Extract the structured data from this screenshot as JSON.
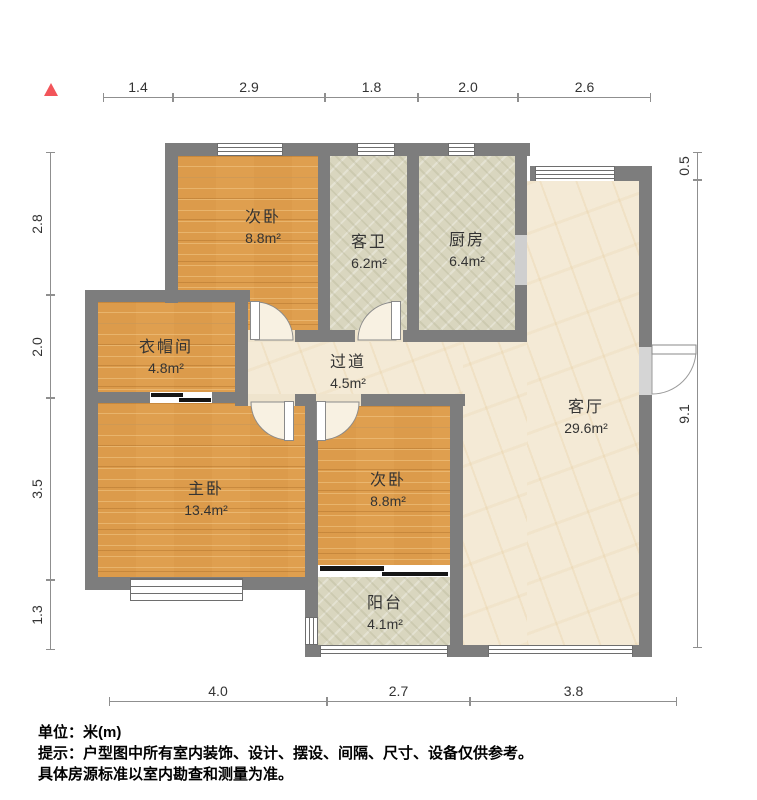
{
  "compass": {
    "icon": "north-triangle",
    "color": "#f2555a"
  },
  "rooms": [
    {
      "key": "bedroom_top",
      "name": "次卧",
      "area": "8.8m²",
      "floor": "wood"
    },
    {
      "key": "guest_bath",
      "name": "客卫",
      "area": "6.2m²",
      "floor": "tile"
    },
    {
      "key": "kitchen",
      "name": "厨房",
      "area": "6.4m²",
      "floor": "tile"
    },
    {
      "key": "hallway",
      "name": "过道",
      "area": "4.5m²",
      "floor": "marble"
    },
    {
      "key": "living_room",
      "name": "客厅",
      "area": "29.6m²",
      "floor": "marble"
    },
    {
      "key": "cloakroom",
      "name": "衣帽间",
      "area": "4.8m²",
      "floor": "wood"
    },
    {
      "key": "master_bedroom",
      "name": "主卧",
      "area": "13.4m²",
      "floor": "wood"
    },
    {
      "key": "bedroom_bottom",
      "name": "次卧",
      "area": "8.8m²",
      "floor": "wood"
    },
    {
      "key": "balcony",
      "name": "阳台",
      "area": "4.1m²",
      "floor": "tile"
    }
  ],
  "dimensions": {
    "unit": "m",
    "top": [
      "1.4",
      "2.9",
      "1.8",
      "2.0",
      "2.6"
    ],
    "left": [
      "2.8",
      "2.0",
      "3.5",
      "1.3"
    ],
    "right": [
      "0.5",
      "9.1"
    ],
    "bottom": [
      "4.0",
      "2.7",
      "3.8"
    ]
  },
  "footer": {
    "unit": "单位：米(m)",
    "note1": "提示：户型图中所有室内装饰、设计、摆设、间隔、尺寸、设备仅供参考。",
    "note2": "具体房源标准以室内勘查和测量为准。"
  },
  "colors": {
    "wall": "#7d7d7d",
    "wood_floor": "#df9f4f",
    "tile_floor": "#d9d6bf",
    "marble_floor": "#f4ead6",
    "north_arrow": "#f2555a",
    "dimension_line": "#8f8f8f"
  }
}
